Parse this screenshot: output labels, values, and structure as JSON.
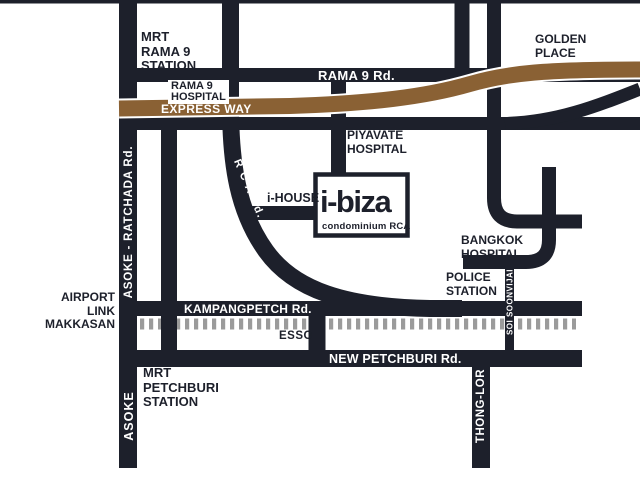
{
  "title": "i-biza condominium RCA location map",
  "colors": {
    "road": "#1d202b",
    "expressway": "#8a6134",
    "railway_dash": "#9b9b9b",
    "background": "#ffffff",
    "label_dark": "#1d202b",
    "label_light": "#ffffff"
  },
  "labels": {
    "mrt_rama9_station": "MRT\nRAMA 9\nSTATION",
    "rama9_hospital": "RAMA 9\nHOSPITAL",
    "express_way": "EXPRESS WAY",
    "rama9_rd": "RAMA 9 Rd.",
    "golden_place": "GOLDEN\nPLACE",
    "asoke_ratchada_rd": "ASOKE - RATCHADA Rd.",
    "piyavate_hospital": "PIYAVATE\nHOSPITAL",
    "rca_rd": "R C A Rd.",
    "i_house": "i-HOUSE",
    "ibiza_name": "i-biza",
    "ibiza_sub": "condominium RCA",
    "bangkok_hospital": "BANGKOK\nHOSPITAL",
    "police_station": "POLICE\nSTATION",
    "soi_soonvijai": "SOI SOONVIJAI",
    "airport_link_makkasan": "AIRPORT\nLINK\nMAKKASAN",
    "kampangpetch_rd": "KAMPANGPETCH Rd.",
    "esso": "ESSO",
    "new_petchburi_rd": "NEW PETCHBURI Rd.",
    "mrt_petchburi_station": "MRT\nPETCHBURI\nSTATION",
    "asoke": "ASOKE",
    "thong_lor": "THONG-LOR"
  }
}
